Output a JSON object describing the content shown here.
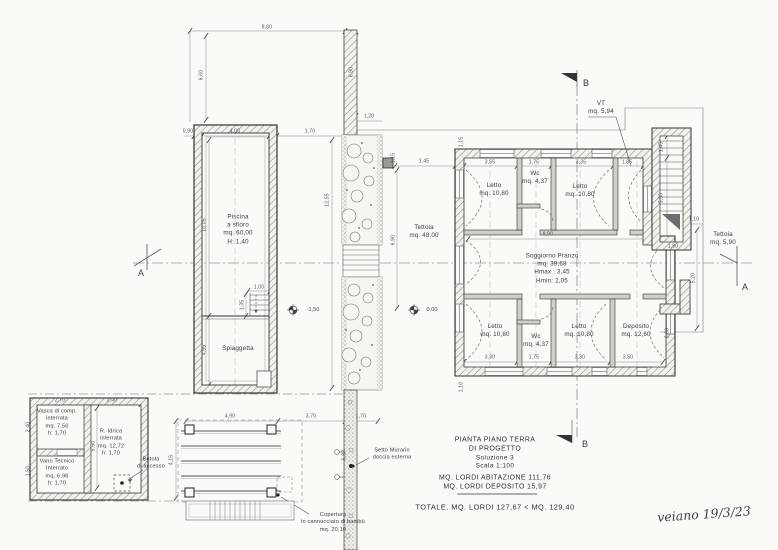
{
  "meta": {
    "drawing_type": "architectural floor plan",
    "colors": {
      "paper": "#fbfaf7",
      "ink": "#3a3a3a",
      "hatch": "#9a9a94",
      "dim_text": "#55555c"
    }
  },
  "labels": {
    "piscina": "Piscina\na sfioro\nmq. 60,00\nH: 1,40",
    "spiaggetta": "Spiaggetta",
    "tettoia_main": "Tettoia\nmq. 48,00",
    "letto_tl": "Letto\nmq. 10,80",
    "wc_top": "Wc\nmq. 4,37",
    "letto_tr": "Letto\nmq. 10,80",
    "soggiorno": "Soggiorno Pranzo\nmq. 39,68\nHmax : 3,45\nHmin: 2,05",
    "letto_bl": "Letto\nmq. 10,80",
    "wc_bottom": "Wc\nmq. 4,37",
    "letto_br": "Letto\nmq. 10,80",
    "deposito": "Deposito\nmq. 12,60",
    "vt": "VT\nmq. 5,94",
    "tettoia_right": "Tettoia\nmq. 5,90",
    "vasca": "Vasca di comp.\ninterrata\nmq. 7,56\nh: 1,70",
    "r_idrica": "R. Idrica\ninterrata\nmq. 12,72\nh: 1,70",
    "vano_tecnico": "Vano Tecnico\nInterrato\nmq. 6,96\nh: 1,70",
    "botola": "Botola\ndi accesso",
    "setto": "Setto Murario\ndoccia esterna",
    "copertura": "Copertura\nin cannucciato di bambù\nmq. 20,10"
  },
  "markers": {
    "elev_spiaggetta": "-1,50",
    "elev_tettoia": "0,00",
    "section_a": "A",
    "section_b": "B"
  },
  "title_block": {
    "line1": "PIANTA PIANO TERRA",
    "line2": "DI PROGETTO",
    "line3": "Soluzione 3",
    "line4": "Scala 1:100",
    "area1": "MQ. LORDI ABITAZIONE 111,76",
    "area2": "MQ. LORDI DEPOSITO 15,97",
    "total": "TOTALE. MQ. LORDI  127,67  <  MQ. 129,40"
  },
  "handwritten_note": "veiano 19/3/23",
  "dims": [
    "8,80",
    "6,60",
    "6,90",
    "1,20",
    "0,90",
    "4,00",
    "1,70",
    "12,55",
    "10,05",
    "4,95",
    "1,00",
    "1,35",
    "4,90",
    "3,70",
    "1,70",
    "4,15",
    "5,80",
    "2,70",
    "2,40",
    "2,40",
    "5,50",
    "1,50",
    "1,45",
    "1,15",
    "6,90",
    "3,55",
    "1,75",
    "3,35",
    "1,85",
    "8,90",
    "3,30",
    "1,75",
    "3,30",
    "3,50",
    "1,45",
    "5,50",
    "1,10",
    "1,80",
    "5,20",
    "3,60",
    "1,10",
    "1,15"
  ]
}
